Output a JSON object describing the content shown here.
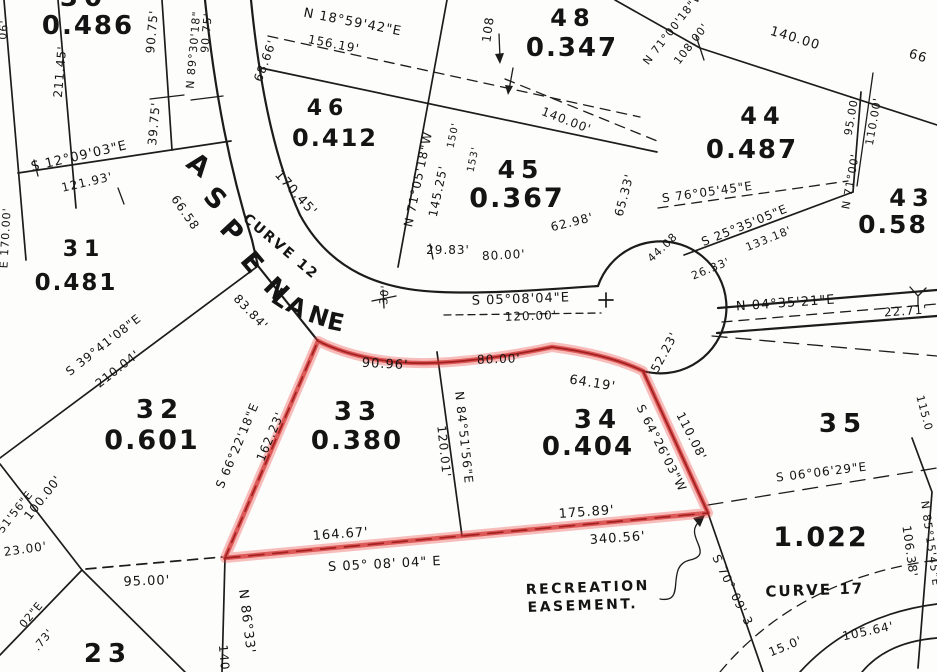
{
  "map": {
    "street_name": "ASPEN LANE",
    "curves": [
      "CURVE 12",
      "CURVE 17"
    ],
    "easement_note": "RECREATION EASEMENT.",
    "highlighted_lots": [
      "33",
      "34"
    ],
    "colors": {
      "paper": "#fdfdfb",
      "ink": "#1c1c1c",
      "highlight": "#cc1c1c"
    },
    "lots": [
      {
        "number": "30",
        "acreage": "0.486"
      },
      {
        "number": "31",
        "acreage": "0.481"
      },
      {
        "number": "32",
        "acreage": "0.601"
      },
      {
        "number": "33",
        "acreage": "0.380"
      },
      {
        "number": "34",
        "acreage": "0.404"
      },
      {
        "number": "35",
        "acreage": ""
      },
      {
        "number": "43",
        "acreage": "0.58"
      },
      {
        "number": "44",
        "acreage": "0.487"
      },
      {
        "number": "45",
        "acreage": "0.367"
      },
      {
        "number": "46",
        "acreage": "0.412"
      },
      {
        "number": "48",
        "acreage": "0.347"
      },
      {
        "number": "23",
        "acreage": ""
      },
      {
        "number": "",
        "acreage": "1.022"
      }
    ],
    "labels": [
      [
        "30",
        84,
        6,
        0,
        26,
        "lot"
      ],
      [
        "0.486",
        88,
        34,
        0,
        26,
        "acr"
      ],
      [
        "90.75'",
        156,
        32,
        -85,
        12,
        "dst"
      ],
      [
        "39.75'",
        158,
        124,
        -85,
        12,
        "dst"
      ],
      [
        "N 89°30'18\"",
        197,
        50,
        -85,
        11,
        "brg"
      ],
      [
        "90.75'",
        210,
        33,
        -85,
        11,
        "dst"
      ],
      [
        "68.66'",
        269,
        62,
        -70,
        12,
        "dst"
      ],
      [
        "211.45'",
        64,
        72,
        -85,
        12,
        "dst"
      ],
      [
        "06'",
        7,
        30,
        -85,
        11,
        "frg"
      ],
      [
        "E 170.00'",
        9,
        238,
        -87,
        11,
        "brg"
      ],
      [
        "S 12°09'03\"E",
        80,
        160,
        -13,
        13,
        "brg"
      ],
      [
        "121.93'",
        88,
        186,
        -13,
        12,
        "dst"
      ],
      [
        "31",
        84,
        256,
        0,
        22,
        "lot"
      ],
      [
        "0.481",
        76,
        290,
        0,
        23,
        "acr"
      ],
      [
        "A",
        193,
        172,
        38,
        27,
        "st"
      ],
      [
        "S",
        209,
        205,
        43,
        27,
        "st"
      ],
      [
        "P",
        225,
        237,
        47,
        27,
        "st"
      ],
      [
        "E",
        245,
        268,
        50,
        27,
        "st"
      ],
      [
        "N",
        270,
        296,
        45,
        27,
        "st"
      ],
      [
        "L",
        276,
        305,
        34,
        24,
        "st"
      ],
      [
        "A",
        293,
        314,
        26,
        24,
        "st"
      ],
      [
        "N",
        316,
        324,
        18,
        24,
        "st"
      ],
      [
        "E",
        334,
        330,
        12,
        24,
        "st"
      ],
      [
        "CURVE 12",
        278,
        250,
        40,
        14,
        "crv"
      ],
      [
        "170.45'",
        293,
        196,
        48,
        13,
        "dst"
      ],
      [
        "66.58",
        182,
        215,
        55,
        12,
        "dst"
      ],
      [
        "83.84'",
        248,
        315,
        46,
        12,
        "dst"
      ],
      [
        "30'",
        388,
        295,
        -85,
        11,
        "dst"
      ],
      [
        "N 18°59'42\"E",
        352,
        26,
        11,
        13,
        "brg"
      ],
      [
        "156.19'",
        333,
        48,
        11,
        12,
        "dst"
      ],
      [
        "46",
        328,
        115,
        0,
        22,
        "lot"
      ],
      [
        "0.412",
        335,
        146,
        0,
        24,
        "acr"
      ],
      [
        "108",
        492,
        30,
        -82,
        12,
        "dst"
      ],
      [
        "140.00'",
        565,
        124,
        21,
        12,
        "dst"
      ],
      [
        "48",
        573,
        26,
        0,
        24,
        "lot"
      ],
      [
        "0.347",
        572,
        56,
        0,
        26,
        "acr"
      ],
      [
        "N 71°00'18\"W",
        676,
        30,
        -52,
        11,
        "brg"
      ],
      [
        "108.00'",
        694,
        46,
        -52,
        11,
        "dst"
      ],
      [
        "140.00",
        794,
        42,
        17,
        13,
        "dst"
      ],
      [
        "66",
        917,
        60,
        17,
        13,
        "dst"
      ],
      [
        "44",
        763,
        124,
        0,
        24,
        "lot"
      ],
      [
        "0.487",
        752,
        158,
        0,
        26,
        "acr"
      ],
      [
        "95.00'",
        855,
        116,
        -80,
        11,
        "dst"
      ],
      [
        "110.00'",
        877,
        122,
        -80,
        11,
        "dst"
      ],
      [
        "N 71°00'",
        854,
        182,
        -80,
        11,
        "brg"
      ],
      [
        "43",
        912,
        206,
        0,
        24,
        "lot"
      ],
      [
        "0.58",
        893,
        233,
        0,
        25,
        "acr"
      ],
      [
        "N 71°05'18\"W",
        422,
        180,
        -78,
        12,
        "brg"
      ],
      [
        "145.25'",
        442,
        192,
        -78,
        12,
        "dst"
      ],
      [
        "150'",
        456,
        136,
        -78,
        10,
        "dst"
      ],
      [
        "153'",
        476,
        160,
        -78,
        10,
        "dst"
      ],
      [
        "45",
        521,
        178,
        0,
        25,
        "lot"
      ],
      [
        "0.367",
        517,
        207,
        0,
        27,
        "acr"
      ],
      [
        "29.83'",
        448,
        254,
        0,
        12,
        "dst"
      ],
      [
        "80.00'",
        504,
        259,
        -3,
        12,
        "dst"
      ],
      [
        "62.98'",
        573,
        226,
        -14,
        12,
        "dst"
      ],
      [
        "65.33'",
        628,
        196,
        -75,
        12,
        "dst"
      ],
      [
        "S 76°05'45\"E",
        708,
        196,
        -8,
        12,
        "brg"
      ],
      [
        "S 25°35'05\"E",
        746,
        229,
        -22,
        12,
        "brg"
      ],
      [
        "26.33'",
        712,
        272,
        -22,
        11,
        "dst"
      ],
      [
        "133.18'",
        770,
        242,
        -22,
        11,
        "dst"
      ],
      [
        "44.08",
        665,
        250,
        -44,
        11,
        "dst"
      ],
      [
        "N 04°35'21\"E",
        786,
        307,
        -4,
        13,
        "brg"
      ],
      [
        "22.71'",
        906,
        315,
        -4,
        12,
        "dst"
      ],
      [
        "52.23'",
        668,
        354,
        -62,
        12,
        "dst"
      ],
      [
        "S 05°08'04\"E",
        521,
        303,
        -2,
        13,
        "brg"
      ],
      [
        "120.00'",
        531,
        320,
        -2,
        12,
        "dst"
      ],
      [
        "90.96'",
        385,
        368,
        3,
        13,
        "dst"
      ],
      [
        "80.00'",
        499,
        363,
        -2,
        12,
        "dst"
      ],
      [
        "64.19'",
        592,
        387,
        9,
        13,
        "dst"
      ],
      [
        "S 66°22'18\"E",
        241,
        447,
        -67,
        12,
        "brg"
      ],
      [
        "162.23'",
        274,
        438,
        -67,
        12,
        "dst"
      ],
      [
        "33",
        358,
        420,
        0,
        26,
        "lot"
      ],
      [
        "0.380",
        357,
        449,
        0,
        26,
        "acr"
      ],
      [
        "N 84°51'56\"E",
        460,
        438,
        84,
        12,
        "brg"
      ],
      [
        "120.01'",
        440,
        452,
        84,
        12,
        "dst"
      ],
      [
        "34",
        598,
        428,
        0,
        26,
        "lot"
      ],
      [
        "0.404",
        588,
        455,
        0,
        26,
        "acr"
      ],
      [
        "S 64°26'03\"W",
        658,
        450,
        63,
        12,
        "brg"
      ],
      [
        "110.08'",
        688,
        438,
        63,
        12,
        "dst"
      ],
      [
        "35",
        843,
        432,
        0,
        26,
        "lot"
      ],
      [
        "32",
        160,
        418,
        0,
        26,
        "lot"
      ],
      [
        "0.601",
        152,
        449,
        0,
        27,
        "acr"
      ],
      [
        "S 39°41'08\"E",
        106,
        348,
        -38,
        12,
        "brg"
      ],
      [
        "210.04'",
        120,
        372,
        -38,
        12,
        "dst"
      ],
      [
        "100.00'",
        46,
        500,
        -52,
        12,
        "dst"
      ],
      [
        "51'56\"E",
        18,
        514,
        -52,
        11,
        "frg"
      ],
      [
        "23.00'",
        26,
        553,
        -8,
        12,
        "dst"
      ],
      [
        "95.00'",
        147,
        585,
        -2,
        13,
        "dst"
      ],
      [
        "02\"E",
        34,
        617,
        -50,
        11,
        "frg"
      ],
      [
        ".73'",
        46,
        642,
        -50,
        11,
        "frg"
      ],
      [
        "23",
        108,
        662,
        0,
        26,
        "lot"
      ],
      [
        "140",
        220,
        658,
        85,
        12,
        "dst"
      ],
      [
        "N 86°33'",
        243,
        622,
        83,
        13,
        "brg"
      ],
      [
        "164.67'",
        341,
        538,
        -4,
        13,
        "dst"
      ],
      [
        "S 05° 08' 04\" E",
        385,
        568,
        -3,
        13,
        "brg"
      ],
      [
        "175.89'",
        587,
        516,
        -4,
        13,
        "dst"
      ],
      [
        "340.56'",
        618,
        542,
        -4,
        13,
        "dst"
      ],
      [
        "RECREATION",
        588,
        592,
        -2,
        14,
        "ft"
      ],
      [
        "EASEMENT.",
        583,
        610,
        -2,
        14,
        "ft"
      ],
      [
        "S 70° 09' 3",
        729,
        592,
        64,
        12,
        "brg"
      ],
      [
        "1.022",
        821,
        546,
        0,
        27,
        "acr"
      ],
      [
        "CURVE 17",
        815,
        595,
        -2,
        15,
        "crv"
      ],
      [
        "15.0'",
        787,
        650,
        -22,
        12,
        "dst"
      ],
      [
        "105.64'",
        869,
        635,
        -12,
        12,
        "dst"
      ],
      [
        "106.38'",
        906,
        552,
        82,
        12,
        "dst"
      ],
      [
        "N 85°15'45\"E",
        927,
        544,
        82,
        11,
        "brg"
      ],
      [
        "115.0",
        921,
        414,
        75,
        11,
        "dst"
      ],
      [
        "S 06°06'29\"E",
        822,
        476,
        -7,
        12,
        "brg"
      ]
    ]
  }
}
